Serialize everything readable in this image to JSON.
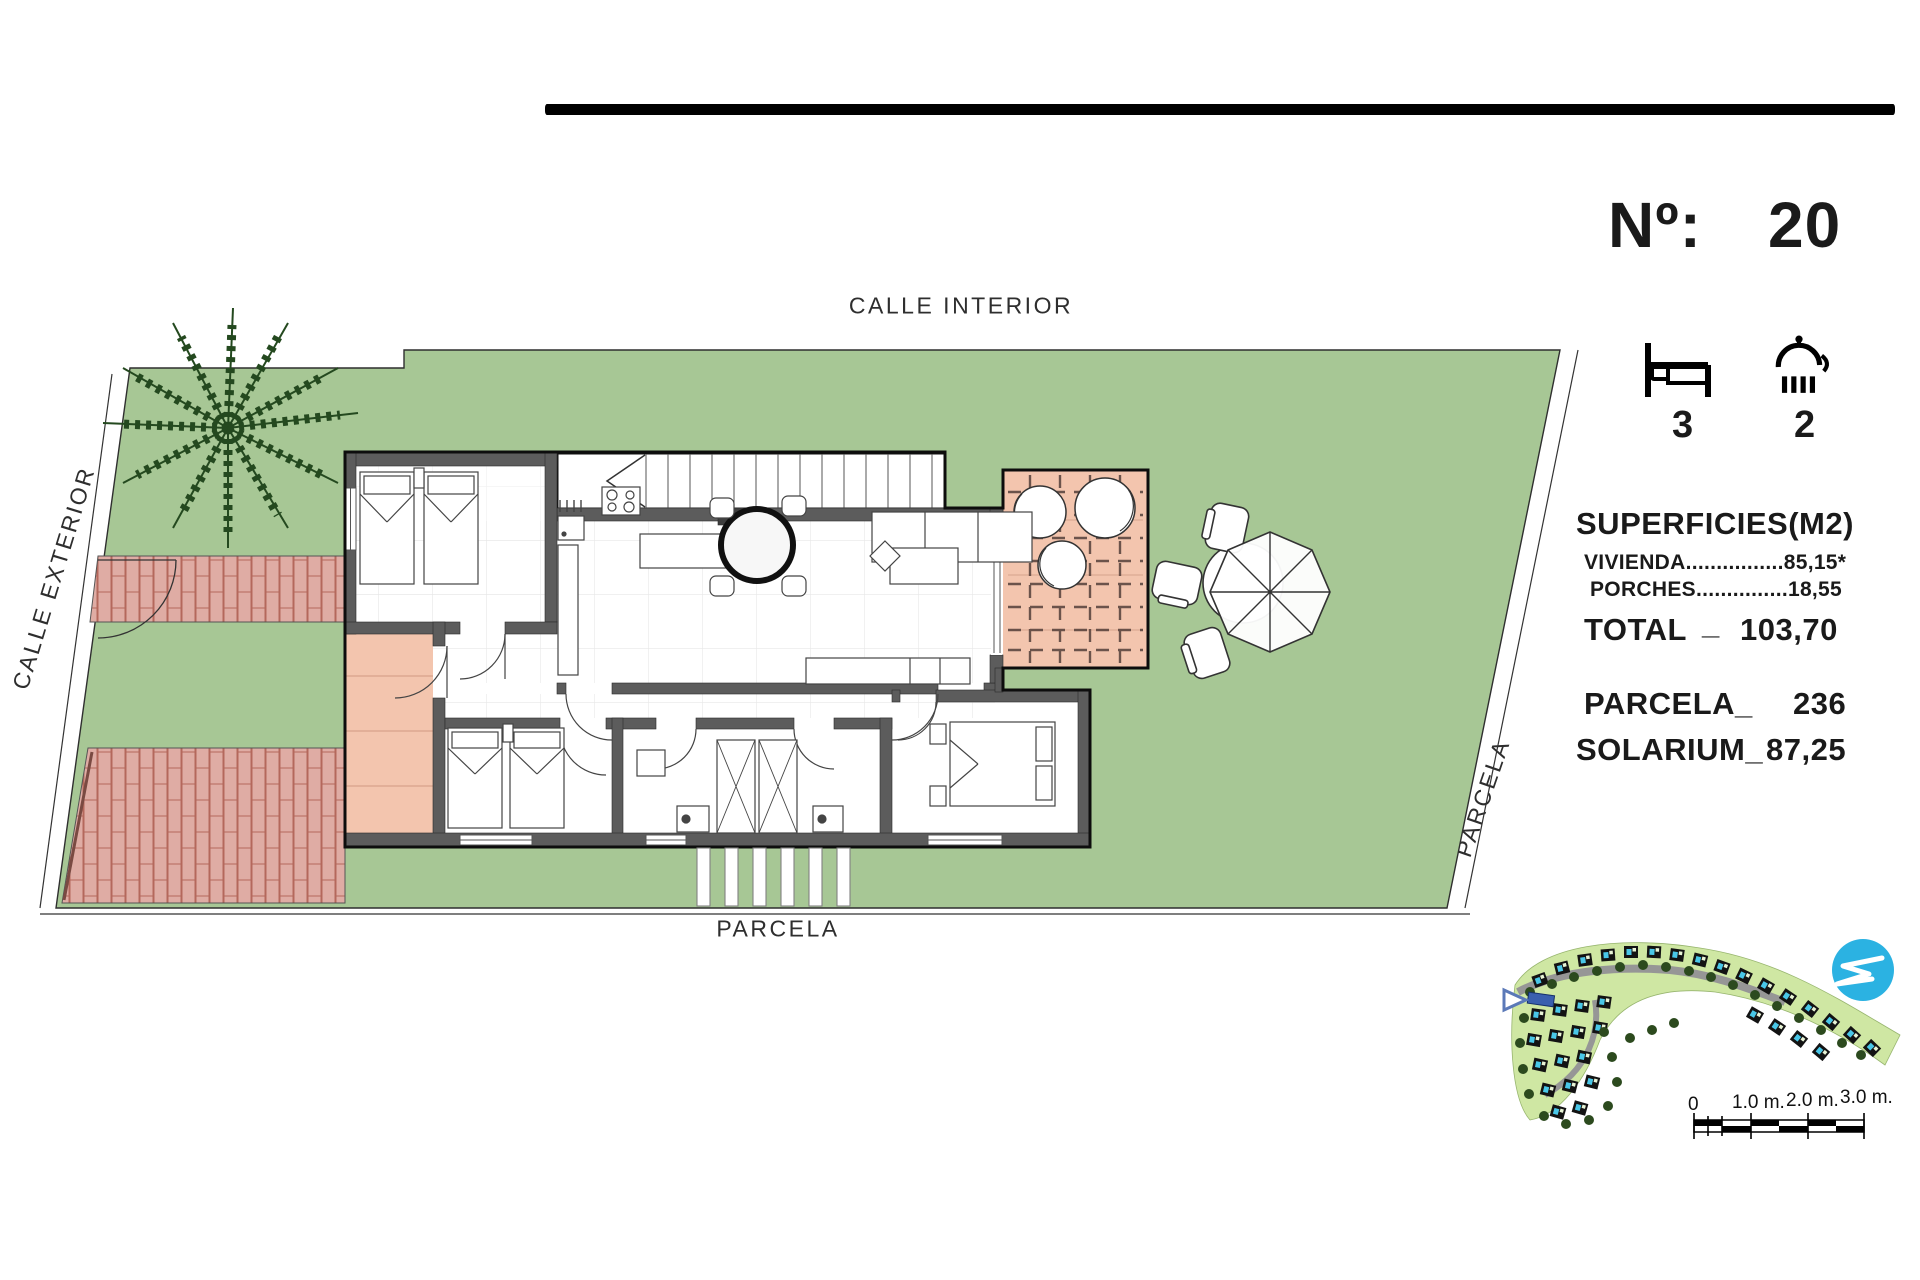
{
  "header": {
    "calle_interior": "CALLE INTERIOR"
  },
  "street_labels": {
    "calle_exterior": "CALLE EXTERIOR",
    "parcela_bottom": "PARCELA",
    "parcela_right": "PARCELA"
  },
  "info_panel": {
    "number_label": "Nº:",
    "number_value": "20",
    "bedrooms": "3",
    "bathrooms": "2",
    "superficies_title": "SUPERFICIES(M2)",
    "vivienda_line": "VIVIENDA................85,15*",
    "porches_line": "PORCHES...............18,55",
    "total_label": "TOTAL",
    "total_separator": "_",
    "total_value": "103,70",
    "parcela_label": "PARCELA_",
    "parcela_value": "236",
    "solarium_label": "SOLARIUM_",
    "solarium_value": "87,25"
  },
  "rooms": [
    {
      "name": "DORMITORIO 3",
      "area": "8.90m2"
    },
    {
      "name": "COCINA",
      "area": "6.35m2"
    },
    {
      "name": "ESTAR COMEDOR",
      "area": "20.05m2"
    },
    {
      "name": "HALL",
      "area": "5.10m2"
    },
    {
      "name": "PASILLO",
      "area": "2.10m2"
    },
    {
      "name": "DORMITORIO 2",
      "area": "9.20m2"
    },
    {
      "name": "BAÑO",
      "area": "3.60m2"
    },
    {
      "name": "ASEO",
      "area": "3.80m2"
    },
    {
      "name": "DORMITORIO 1",
      "area": "12.25m2"
    },
    {
      "name": "PORCHE 1",
      "area": "6.20m2"
    },
    {
      "name": "PORCHE 2",
      "area": "12.35m2"
    }
  ],
  "scale_bar": {
    "labels": [
      "0",
      "1.0 m.",
      "2.0 m.",
      "3.0 m."
    ]
  },
  "colors": {
    "lawn_green": "#a7c795",
    "porch_salmon": "#f3c5ae",
    "brick_fill": "#dfaca4",
    "brick_joint": "#b4685c",
    "wall_gray": "#5c5c5c",
    "masterplan_green": "#cfe7a3",
    "pool_cyan": "#49c7e8",
    "plot_highlight_blue": "#3a5fae",
    "logo_blue": "#2bb2e2"
  }
}
